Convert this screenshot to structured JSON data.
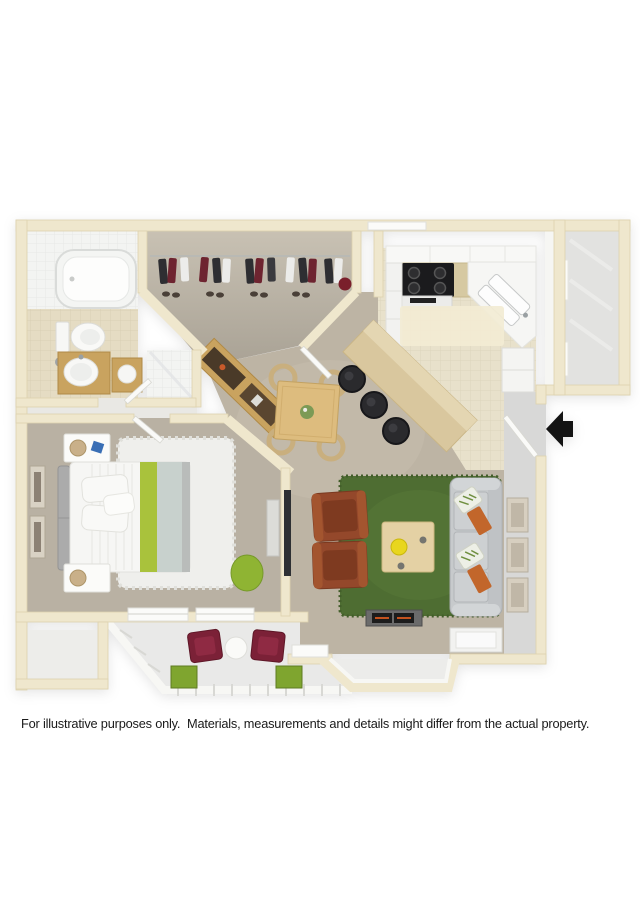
{
  "page": {
    "background_color": "#ffffff"
  },
  "floor_plan": {
    "view": "3D top-down apartment floor plan rendering",
    "entry_arrow": {
      "shape": "left-pointing solid arrow",
      "color": "#141414"
    },
    "palette": {
      "wall_cream": "#EFE7CD",
      "carpet_taupe": "#BDB4A4",
      "closet_floor": "#B3AC9E",
      "kitchen_tile": "#E8E1CB",
      "bath_tile_beige": "#E5DCC3",
      "bath_tile_white": "#F3F4F2",
      "entry_tile_gray": "#D8D8D7",
      "storage_floor": "#E2E2E0",
      "patio_floor": "#E9E9E8",
      "rug_green": "#4E6D32",
      "rug_white": "#EFEFEC",
      "sofa_gray": "#C7CACC",
      "armchair_brown": "#94482B",
      "wood_light": "#DDBC7E",
      "wood_mid": "#C9A35F",
      "bar_stool_black": "#2A2A2D",
      "bed_accent_green": "#A9C23C",
      "patio_chair_maroon": "#7B2137",
      "planter_green": "#86A92F"
    },
    "rooms": [
      {
        "name": "Bathroom",
        "furniture": [
          "bathtub",
          "toilet",
          "wood sink vanity",
          "side cabinet",
          "shower"
        ]
      },
      {
        "name": "Walk-in Closet",
        "furniture": [
          "hanging clothes on rod",
          "shoes"
        ]
      },
      {
        "name": "Kitchen",
        "furniture": [
          "black cooktop stove",
          "upper cabinets",
          "angled counter with double sink",
          "refrigerator",
          "floor mat"
        ]
      },
      {
        "name": "Dining Area",
        "furniture": [
          "square wood dining table with plant centerpiece",
          "4 wicker chairs",
          "wood sideboard",
          "breakfast bar",
          "3 black bar stools"
        ]
      },
      {
        "name": "Storage Room",
        "furniture": []
      },
      {
        "name": "Entry",
        "furniture": [
          "wall art frames"
        ]
      },
      {
        "name": "Bedroom",
        "furniture": [
          "bed with green runner",
          "2 white nightstands with lamps",
          "white shag rug",
          "2 wall art frames",
          "dresser",
          "wall TV",
          "green beanbag"
        ]
      },
      {
        "name": "Living Room",
        "furniture": [
          "gray sofa with pillows and orange throws",
          "2 brown leather armchairs",
          "wood coffee table with yellow bowl",
          "green shag rug",
          "fireplace",
          "window seat",
          "bay window"
        ]
      },
      {
        "name": "Patio",
        "furniture": [
          "2 maroon chairs",
          "round white side table",
          "2 green planter boxes",
          "railing"
        ]
      }
    ]
  },
  "disclaimer": "For illustrative purposes only.  Materials, measurements and details might differ from the actual property."
}
